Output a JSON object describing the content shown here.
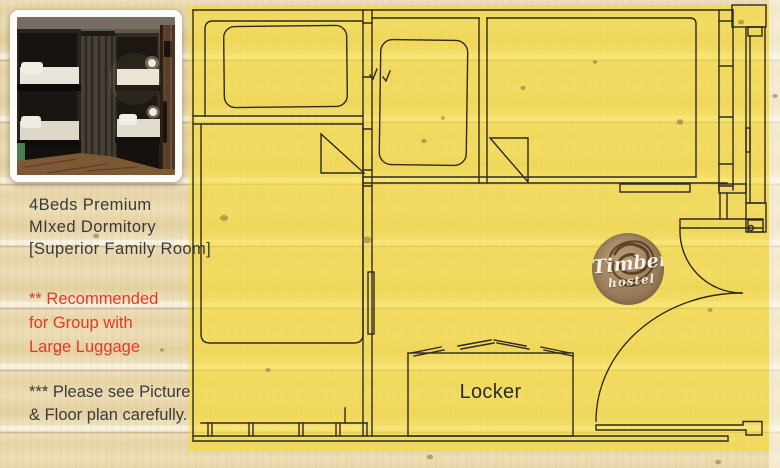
{
  "colors": {
    "accent_red": "#e23a2b",
    "overlay_yellow": "#f7db24",
    "plan_line_dark": "#2d2a25",
    "text_dark": "#3a3a3a",
    "logo_wood_brown": "#9b7f5c"
  },
  "info_panel": {
    "title_lines": [
      "4Beds Premium",
      "MIxed Dormitory",
      "[Superior Family Room]"
    ],
    "recommend_lines": [
      "** Recommended",
      "for Group with",
      "Large Luggage"
    ],
    "note_lines": [
      "*** Please see Picture",
      "& Floor plan carefully."
    ]
  },
  "floorplan": {
    "locker_label": "Locker",
    "logo": {
      "brand": "Timber",
      "sub": "hostel"
    }
  }
}
